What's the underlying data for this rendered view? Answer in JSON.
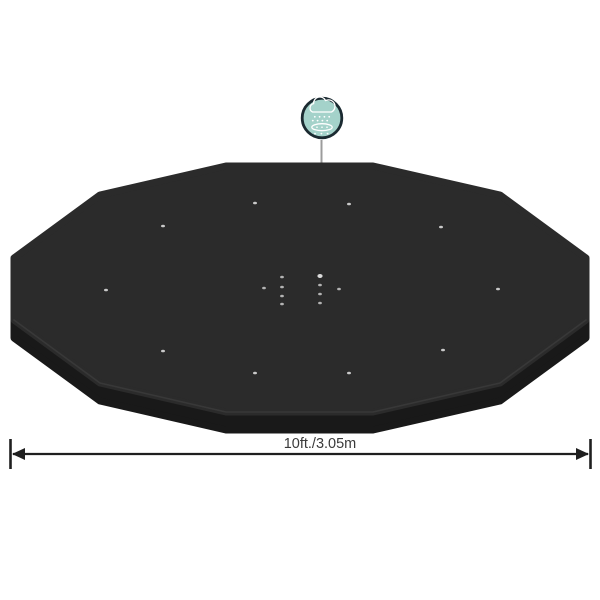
{
  "colors": {
    "background": "#ffffff",
    "cover_surface": "#2b2b2b",
    "cover_skirt": "#191919",
    "cover_edge_highlight": "#444444",
    "grommet": "#c9c9c9",
    "drain_hole": "#b3b3b3",
    "drain_hole_bright": "#dcdcdc",
    "callout_line": "#9c9c9c",
    "icon_fill": "#a4d2ca",
    "icon_ring": "#1b2a31",
    "icon_glyph": "#ffffff",
    "dimension": "#1f1f1f",
    "dimension_text": "#3a3a3a"
  },
  "subject": "black dodecagonal pool cover, top perspective view",
  "callout": {
    "icon": "rain-drain-icon"
  },
  "dimension": {
    "label": "10ft./3.05m"
  }
}
